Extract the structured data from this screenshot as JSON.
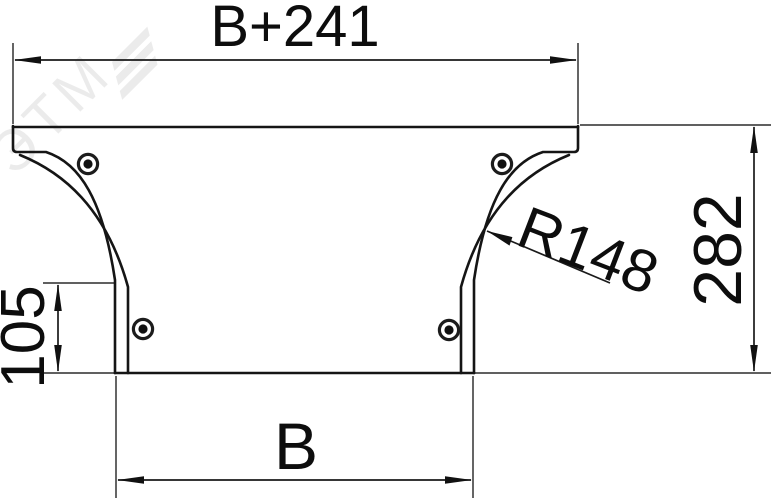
{
  "drawing": {
    "kind": "dimension-drawing",
    "labels": {
      "top_width": "B+241",
      "overall_height": "282",
      "side_offset": "105",
      "bottom_width": "B",
      "radius": "R148"
    },
    "rivet_count": 4,
    "watermark": {
      "text": "ЭТМ"
    },
    "colors": {
      "outline": "#151515",
      "dimension_line": "#1a1a1a",
      "extension_line": "#4a4a4a",
      "text": "#0d0d0d",
      "watermark": "rgba(0,0,0,0.08)",
      "background": "#ffffff"
    }
  }
}
